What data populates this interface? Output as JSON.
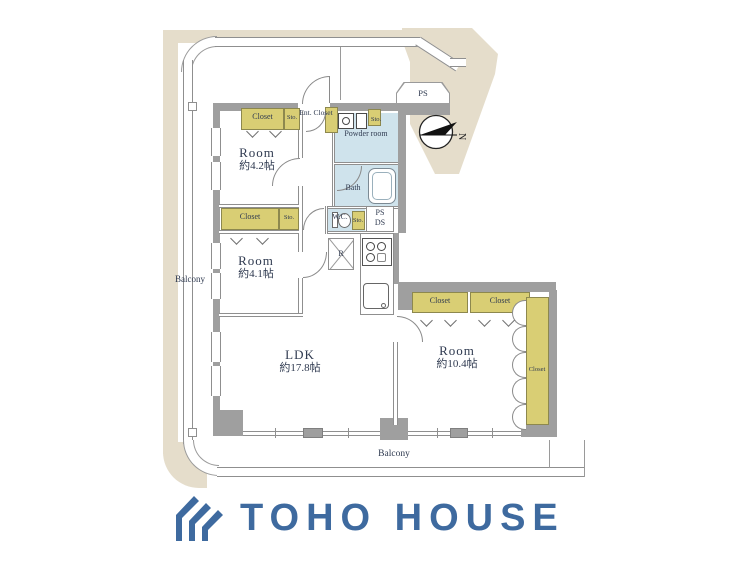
{
  "plan": {
    "rooms": {
      "room42": {
        "name": "Room",
        "size": "約4.2帖"
      },
      "room41": {
        "name": "Room",
        "size": "約4.1帖"
      },
      "ldk": {
        "name": "LDK",
        "size": "約17.8帖"
      },
      "room104": {
        "name": "Room",
        "size": "約10.4帖"
      }
    },
    "labels": {
      "closet": "Closet",
      "sto": "Sto.",
      "ent_closet": "Ent. Closet",
      "powder_room": "Powder room",
      "bath": "Bath",
      "wc": "W.C.",
      "ps": "PS",
      "ds": "DS",
      "r": "R",
      "balcony": "Balcony",
      "north": "N"
    }
  },
  "logo": {
    "name": "TOHO HOUSE"
  },
  "colors": {
    "beige": "#e5ddcb",
    "wall_gray": "#9f9f9f",
    "closet_yellow": "#d9ce74",
    "water_blue": "#cfe3ec",
    "logo_blue": "#3e6a9f"
  }
}
